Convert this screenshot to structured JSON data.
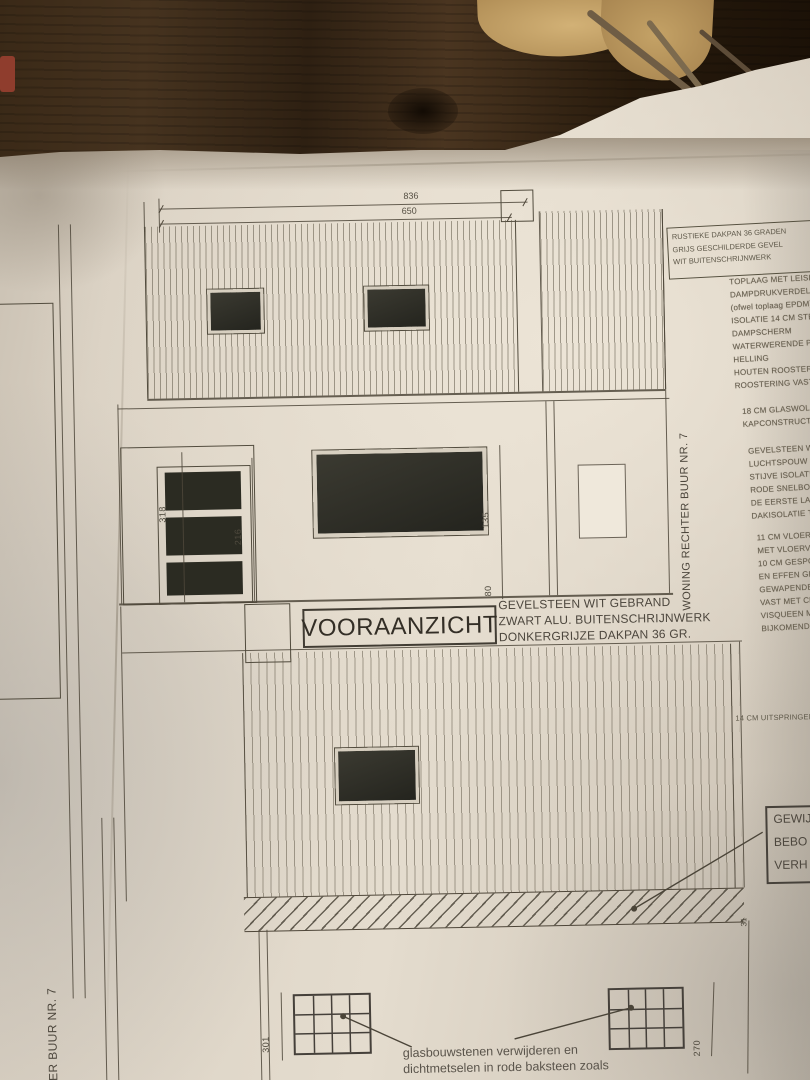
{
  "drawing": {
    "title": "VOORAANZICHT",
    "finish_notes": [
      "GEVELSTEEN WIT GEBRAND",
      "ZWART ALU. BUITENSCHRIJNWERK",
      "DONKERGRIJZE DAKPAN 36 GR."
    ],
    "bottom_note": [
      "glasbouwstenen verwijderen en",
      "dichtmetselen in rode baksteen zoals"
    ],
    "neighbor_right_label": "WONING RECHTER BUUR NR. 7",
    "neighbor_left_label": "CHTER BUUR NR. 7",
    "overhang_note": "14 CM UITSPRINGEND",
    "revision_box": [
      "GEWIJ",
      "BEBO",
      "VERH"
    ]
  },
  "dimensions": {
    "total_width": "836",
    "roof_width": "650",
    "door_height": "318",
    "door_frame": "216",
    "window_height": "135",
    "parapet_height": "80",
    "band_thickness": "31",
    "left_opening": "301",
    "right_opening": "270"
  },
  "spec_box": [
    "RUSTIEKE DAKPAN 36 GRADEN",
    "GRIJS GESCHILDERDE GEVEL",
    "WIT BUITENSCHRIJNWERK"
  ],
  "roof_spec": [
    "TOPLAAG MET LEISLAG",
    "DAMPDRUKVERDELEND",
    "(ofwel toplaag EPDM)",
    "ISOLATIE 14 CM STEN",
    "DAMPSCHERM",
    "WATERWERENDE PLA",
    "HELLING",
    "HOUTEN ROOSTERIN",
    "ROOSTERING VAST"
  ],
  "attic_spec": [
    "18 CM GLASWOL ME",
    "KAPCONSTRUCTIE"
  ],
  "wall_spec": [
    "GEVELSTEEN WIT",
    "LUCHTSPOUW 3 C",
    "STIJVE ISOLATIE",
    "RODE SNELBOUW",
    "DE EERSTE LAAG",
    "DAKISOLATIE TE"
  ],
  "floor_spec": [
    "11 CM VLOERISOL",
    "MET VLOERVERW",
    "10 CM GESPOTEN",
    "EN EFFEN GE",
    "GEWAPENDE",
    "VAST MET CH",
    "VISQUEEN ME",
    "BIJKOMENDE"
  ],
  "colors": {
    "paper": "#ddd4c6",
    "line": "#4e4639",
    "glass": "#2e2d26",
    "wood": "#3c2a18"
  }
}
